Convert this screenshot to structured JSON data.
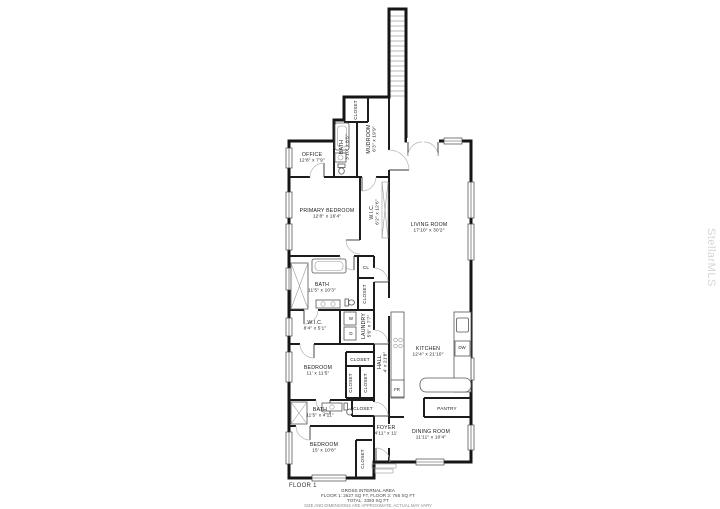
{
  "watermark": "StellarMLS",
  "plan": {
    "floor_label": "FLOOR 1",
    "footer": {
      "line1": "GROSS INTERNAL AREA",
      "line2": "FLOOR 1: 2627 SQ FT, FLOOR 2: 766 SQ FT",
      "line3": "TOTAL: 3393 SQ FT",
      "line4": "SIZE AND DIMENSIONS ARE APPROXIMATE, ACTUAL MAY VARY"
    },
    "rooms": [
      {
        "name": "OFFICE",
        "dims": "12'8\" x 7'9\"",
        "x": 312,
        "y": 156,
        "rotate": 0
      },
      {
        "name": "CLOSET",
        "dims": "",
        "x": 357,
        "y": 110,
        "rotate": -90,
        "small": true
      },
      {
        "name": "BATH",
        "dims": "3'10\" x 8'5\"",
        "x": 343,
        "y": 147,
        "rotate": -90
      },
      {
        "name": "MUDROOM",
        "dims": "6'3\" x 19'9\"",
        "x": 370,
        "y": 139,
        "rotate": -90
      },
      {
        "name": "PRIMARY BEDROOM",
        "dims": "12'8\" x 16'4\"",
        "x": 327,
        "y": 212,
        "rotate": 0
      },
      {
        "name": "W.I.C.",
        "dims": "6'2\" x 12'6\"",
        "x": 373,
        "y": 212,
        "rotate": -90
      },
      {
        "name": "LIVING ROOM",
        "dims": "17'10\" x 30'2\"",
        "x": 429,
        "y": 226,
        "rotate": 0
      },
      {
        "name": "BATH",
        "dims": "11'5\" x 10'3\"",
        "x": 322,
        "y": 286,
        "rotate": 0
      },
      {
        "name": "CL",
        "dims": "",
        "x": 366,
        "y": 269,
        "rotate": 0,
        "small": true
      },
      {
        "name": "CLOSET",
        "dims": "",
        "x": 366,
        "y": 294,
        "rotate": -90,
        "small": true
      },
      {
        "name": "W.I.C.",
        "dims": "8'4\" x 5'1\"",
        "x": 315,
        "y": 324,
        "rotate": 0
      },
      {
        "name": "LAUNDRY",
        "dims": "5'6\" x 7'7\"",
        "x": 365,
        "y": 326,
        "rotate": -90
      },
      {
        "name": "HALL",
        "dims": "4' x 21'8\"",
        "x": 381,
        "y": 362,
        "rotate": -90
      },
      {
        "name": "KITCHEN",
        "dims": "12'4\" x 21'10\"",
        "x": 428,
        "y": 350,
        "rotate": 0
      },
      {
        "name": "BEDROOM",
        "dims": "11' x 11'5\"",
        "x": 318,
        "y": 369,
        "rotate": 0
      },
      {
        "name": "CLOSET",
        "dims": "",
        "x": 360,
        "y": 361,
        "rotate": 0,
        "small": true
      },
      {
        "name": "CLOSET",
        "dims": "",
        "x": 352,
        "y": 383,
        "rotate": -90,
        "small": true
      },
      {
        "name": "CLOSET",
        "dims": "",
        "x": 367,
        "y": 383,
        "rotate": -90,
        "small": true
      },
      {
        "name": "PANTRY",
        "dims": "",
        "x": 447,
        "y": 410,
        "rotate": 0,
        "small": true
      },
      {
        "name": "BATH",
        "dims": "11'5\" x 4'11\"",
        "x": 320,
        "y": 411,
        "rotate": 0
      },
      {
        "name": "CLOSET",
        "dims": "",
        "x": 363,
        "y": 410,
        "rotate": 0,
        "small": true
      },
      {
        "name": "FOYER",
        "dims": "4'11\" x 11'",
        "x": 386,
        "y": 429,
        "rotate": 0
      },
      {
        "name": "BEDROOM",
        "dims": "15' x 10'8\"",
        "x": 324,
        "y": 446,
        "rotate": 0
      },
      {
        "name": "CLOSET",
        "dims": "",
        "x": 364,
        "y": 459,
        "rotate": -90,
        "small": true
      },
      {
        "name": "DINING ROOM",
        "dims": "11'11\" x 10'4\"",
        "x": 431,
        "y": 433,
        "rotate": 0
      }
    ],
    "fixtures": [
      {
        "label": "W",
        "x": 351,
        "y": 320
      },
      {
        "label": "D",
        "x": 351,
        "y": 335
      },
      {
        "label": "DW",
        "x": 462,
        "y": 349
      },
      {
        "label": "FR",
        "x": 397,
        "y": 391
      }
    ]
  }
}
